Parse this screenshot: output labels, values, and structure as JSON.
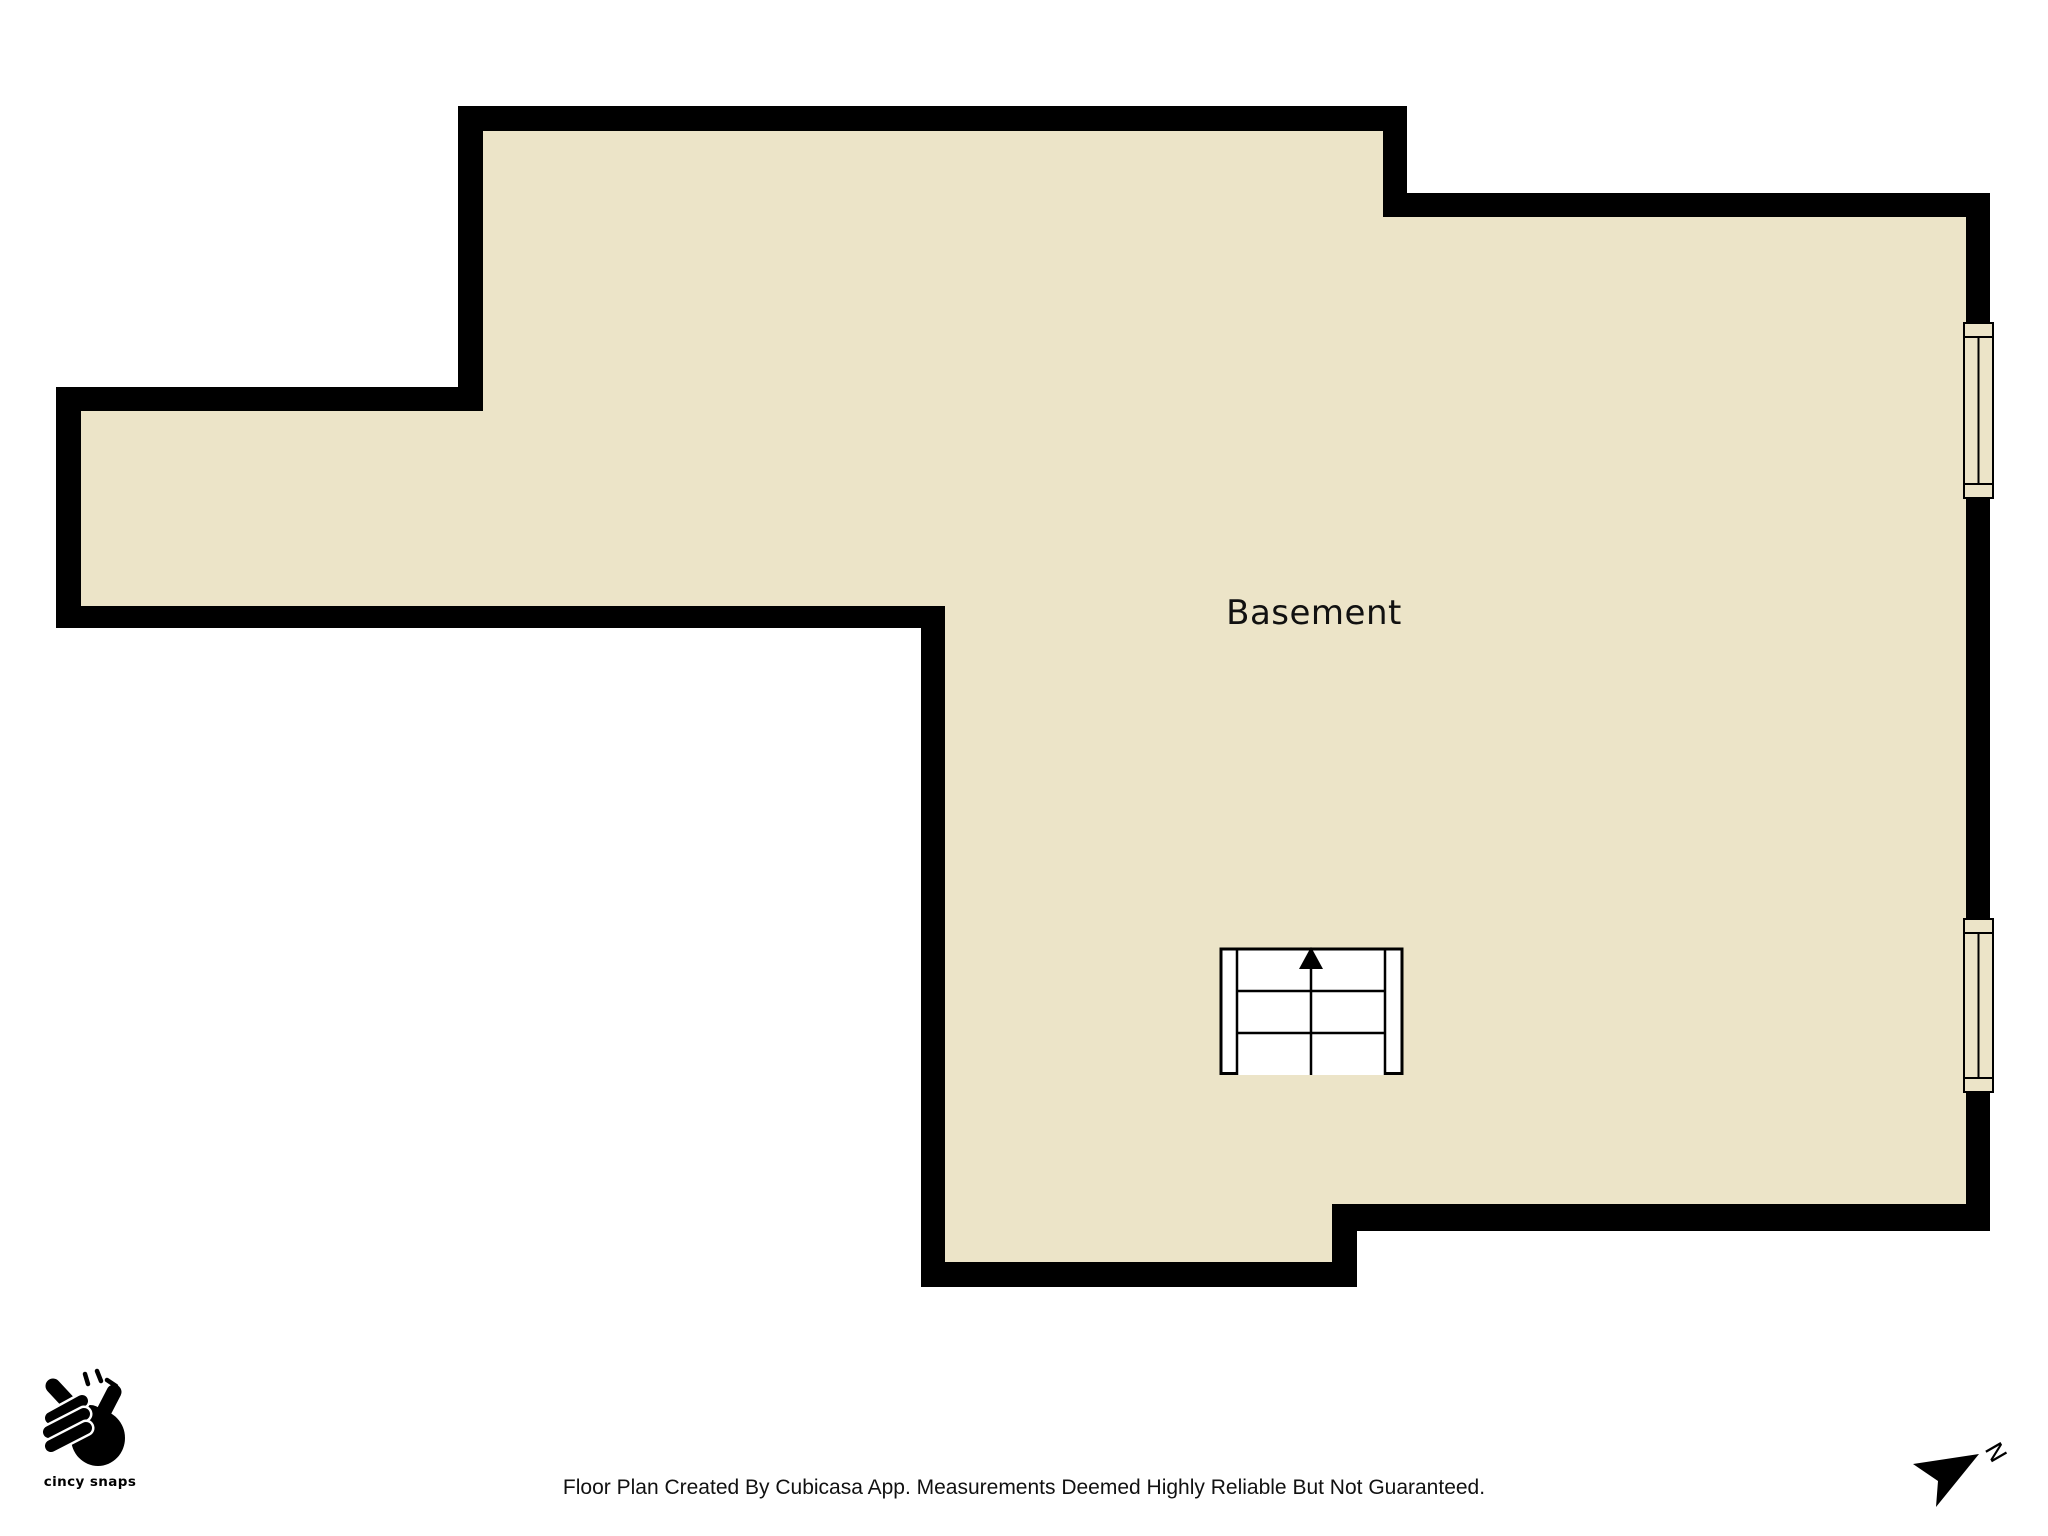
{
  "page": {
    "width": 2048,
    "height": 1536
  },
  "colors": {
    "wall": "#000000",
    "floor": "#ECE4C8",
    "outside": "#FFFFFF",
    "symbol": "#FFFFFF",
    "text": "#111111"
  },
  "floorplan": {
    "room_label": "Basement",
    "features": {
      "windows_count": 2,
      "staircase": "three steps, up-arrow pointing north"
    }
  },
  "footer": {
    "logo_text": "cincy snaps",
    "disclaimer": "Floor Plan Created By Cubicasa App. Measurements Deemed Highly Reliable But Not Guaranteed."
  },
  "compass": {
    "north_label": "N"
  }
}
